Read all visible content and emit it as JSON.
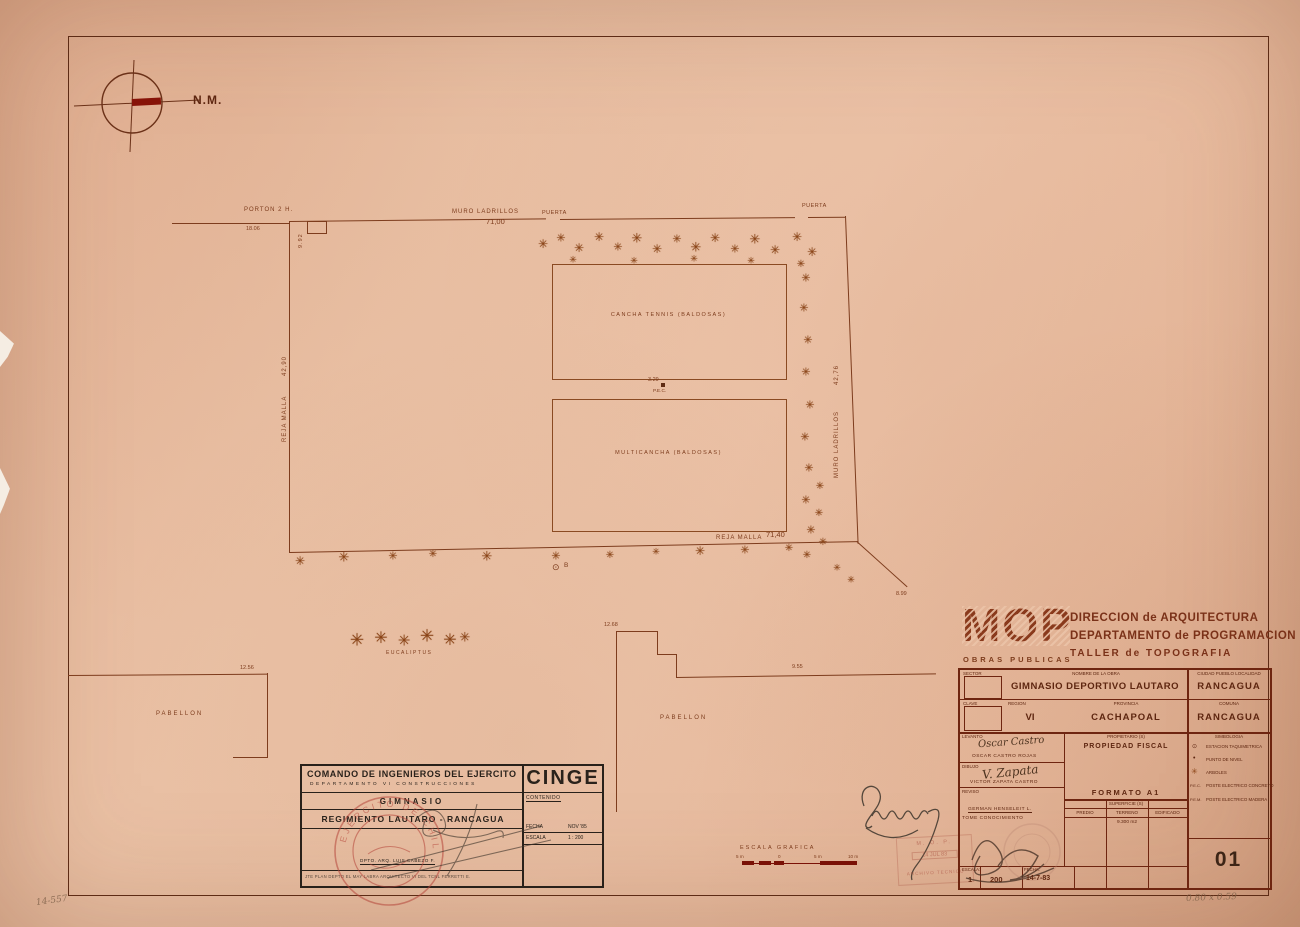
{
  "icons": {
    "tree": "✳",
    "station": "⊙",
    "north_label": "N.M."
  },
  "north": {
    "label": "N.M."
  },
  "plan": {
    "porton_label": "PORTON 2 H.",
    "porton_dim": "18.06",
    "porton_side_dim": "9.92",
    "muro_top_label": "MURO LADRILLOS",
    "muro_top_dim": "71,00",
    "puerta1": "PUERTA",
    "puerta2": "PUERTA",
    "muro_right_label": "MURO LADRILLOS",
    "muro_right_dim": "42,76",
    "reja_left_label": "REJA MALLA",
    "reja_left_dim": "42,90",
    "reja_bottom_label": "REJA MALLA",
    "reja_bottom_dim": "71,40",
    "corner_dim": "8.99",
    "tennis": "CANCHA TENNIS (BALDOSAS)",
    "multi": "MULTICANCHA (BALDOSAS)",
    "pec_dim": "3.29",
    "pec": "P.E.C.",
    "station_b": "B",
    "eucaliptus": "EUCALIPTUS",
    "pabellon_left": "PABELLON",
    "pabellon_left_dim": "12.56",
    "pabellon_center": "PABELLON",
    "pabellon_center_dim1": "12.68",
    "pabellon_center_dim2": "9.55"
  },
  "cinge": {
    "title": "COMANDO DE INGENIEROS DEL EJERCITO",
    "subtitle": "DEPARTAMENTO   VI   CONSTRUCCIONES",
    "logo": "CINGE",
    "contenido_label": "CONTENIDO",
    "line1": "GIMNASIO",
    "line2": "REGIMIENTO  LAUTARO - RANCAGUA",
    "fecha_label": "FECHA",
    "fecha": "NOV '85",
    "escala_label": "ESCALA",
    "escala": "1 : 200",
    "sig_caption": "DPTO. ARQ.      LUIS CABEZO F.",
    "footer": "JTE PLAN DEPTO EL MAY LABRA        ARQUITECTO VI DEL TCNL FERRETTI E."
  },
  "mop": {
    "logo": "MOP",
    "obras": "OBRAS  PUBLICAS",
    "line1": "DIRECCION  de  ARQUITECTURA",
    "line2": "DEPARTAMENTO de PROGRAMACION",
    "line3": "TALLER   de   TOPOGRAFIA"
  },
  "titleblock": {
    "hdr_sector": "SECTOR",
    "hdr_nombre": "NOMBRE  DE  LA  OBRA",
    "hdr_ciudad": "CIUDAD  PUEBLO  LOCALIDAD",
    "obra": "GIMNASIO DEPORTIVO LAUTARO",
    "ciudad": "RANCAGUA",
    "hdr_clave": "CLAVE",
    "hdr_region": "REGION",
    "hdr_provincia": "PROVINCIA",
    "hdr_comuna": "COMUNA",
    "region": "VI",
    "provincia": "CACHAPOAL",
    "comuna": "RANCAGUA",
    "levanto_label": "LEVANTO",
    "levanto_sig": "Oscar Castro",
    "levanto_name": "OSCAR CASTRO ROJAS",
    "dibujo_label": "DIBUJO",
    "dibujo_sig": "V. Zapata",
    "dibujo_name": "VICTOR ZAPATA CASTRO",
    "reviso_label": "REVISO",
    "reviso_name": "GERMAN HENSELEIT L.",
    "reviso_note": "TOME CONOCIMIENTO",
    "prop_label": "PROPIETARIO (S)",
    "prop": "PROPIEDAD  FISCAL",
    "formato": "FORMATO  A1",
    "sup_label": "SUPERFICIE (S)",
    "sup_cols": [
      "PREDIO",
      "TERRENO",
      "EDIFICADO"
    ],
    "sup_terreno": "9.300 m2",
    "simb_label": "SIMBOLOGIA",
    "simbologia": [
      {
        "sym": "⊙",
        "label": "ESTACION TAQUIMETRICA"
      },
      {
        "sym": "•",
        "label": "PUNTO DE NIVEL"
      },
      {
        "sym": "✳",
        "label": "ARBOLES"
      },
      {
        "sym": "P.E.C.",
        "label": "POSTE ELECTRICO CONCRETO"
      },
      {
        "sym": "P.E.M.",
        "label": "POSTE ELECTRICO MADERA"
      }
    ],
    "escala_label": "ESCALA:",
    "escala_num": "1",
    "escala_den": "200",
    "fecha_label": "FECHA:",
    "fecha": "14-7-83",
    "sheet": "01"
  },
  "scalebar": {
    "label": "ESCALA  GRAFICA",
    "ticks": [
      "5 m",
      "0",
      "5 m",
      "10 m"
    ]
  },
  "stamps": {
    "circular": "EJERCITO DE CHILE",
    "rect_line1": "M. O. P.",
    "rect_line2": "14 JUL 83",
    "rect_line3": "ARCHIVO TECNICO"
  },
  "notes": {
    "bottom_left": "14-557",
    "bottom_right": "0.80 x 0.59"
  }
}
